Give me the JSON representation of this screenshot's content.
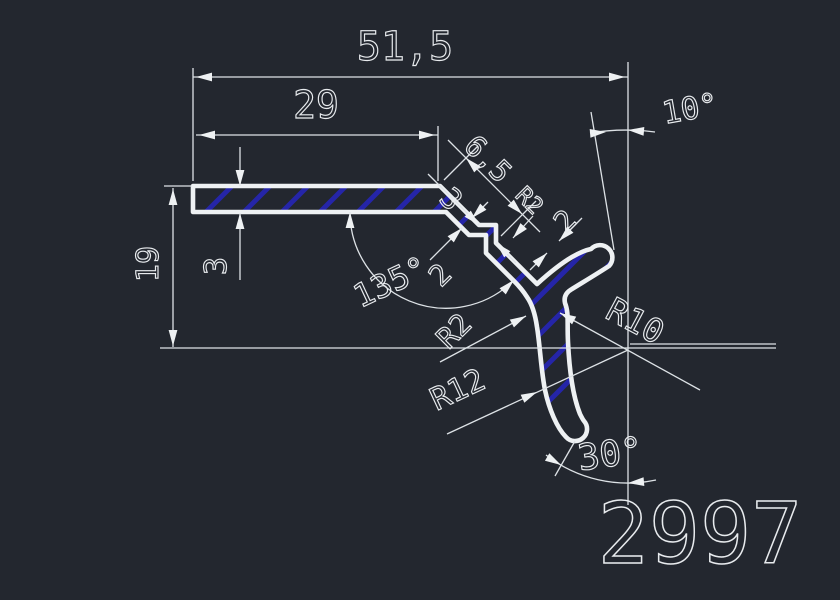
{
  "drawing_number": "2997",
  "colors": {
    "background": "#23272f",
    "line": "#eef1f3",
    "hatch_blue": "#2525a8"
  },
  "dims": {
    "total_width": "51,5",
    "flange_width": "29",
    "height": "19",
    "flange_thickness": "3",
    "step_offset": "3",
    "step_width": "6,5",
    "top_angle": "10°",
    "bend_angle": "135°",
    "web_thickness": "2",
    "arm_thickness": "2",
    "fillet_radius": "R2",
    "step_radius": "R2",
    "arm_radius": "R10",
    "hook_radius": "R12",
    "hook_angle": "30°"
  }
}
